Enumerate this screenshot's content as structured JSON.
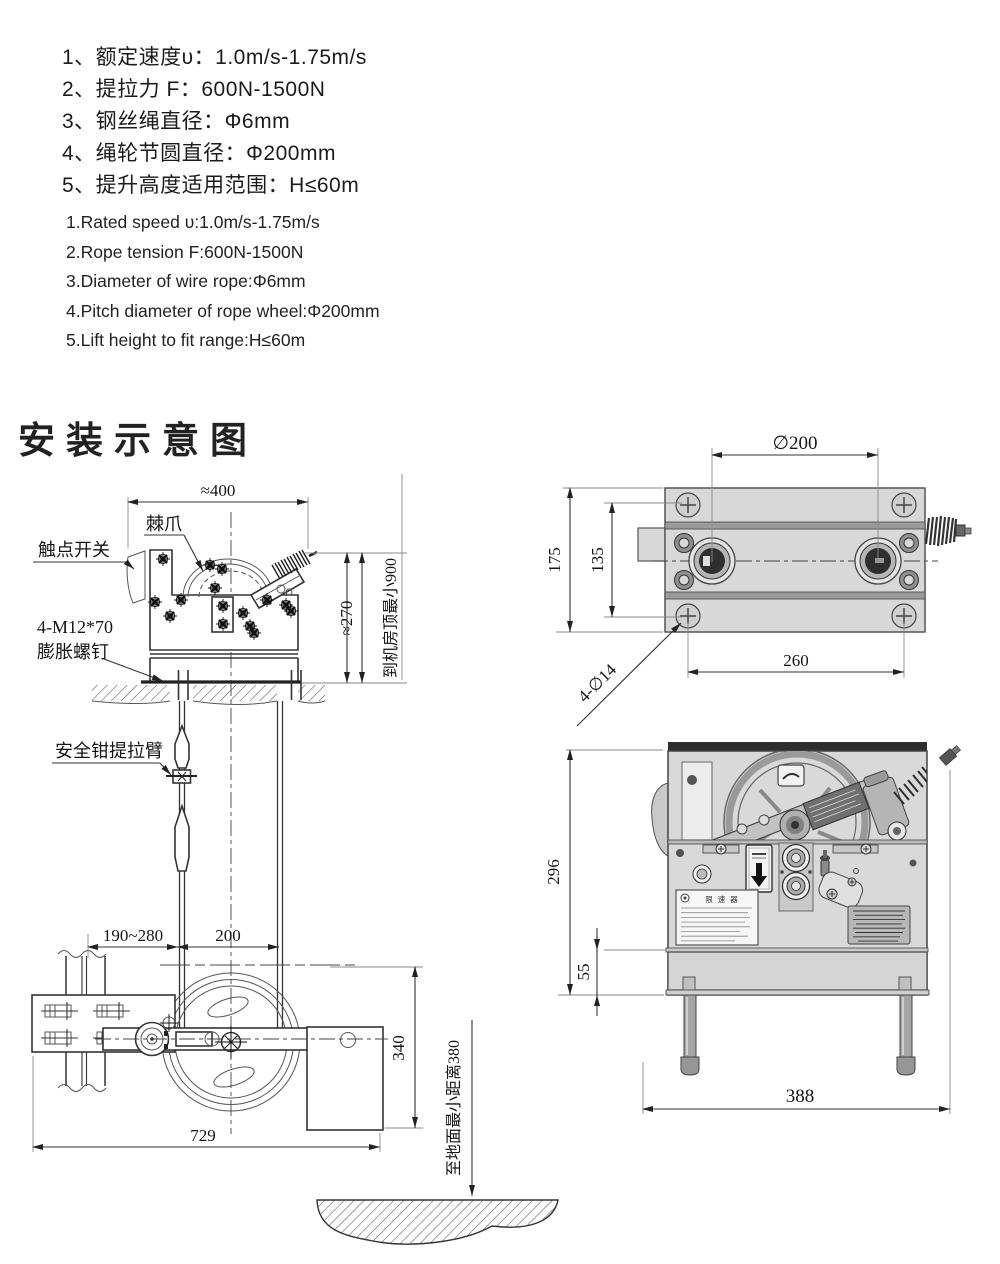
{
  "specs_cn": {
    "items": [
      "1、额定速度υ：1.0m/s-1.75m/s",
      "2、提拉力 F：600N-1500N",
      "3、钢丝绳直径：Φ6mm",
      "4、绳轮节圆直径：Φ200mm",
      "5、提升高度适用范围：H≤60m"
    ]
  },
  "specs_en": {
    "items": [
      "1.Rated speed υ:1.0m/s-1.75m/s",
      "2.Rope tension F:600N-1500N",
      "3.Diameter of wire rope:Φ6mm",
      "4.Pitch diameter of rope wheel:Φ200mm",
      "5.Lift height to fit range:H≤60m"
    ]
  },
  "section_title": "安装示意图",
  "front_view": {
    "labels": {
      "pawl": "棘爪",
      "contact_switch": "触点开关",
      "anchor_bolt_spec": "4-M12*70",
      "anchor_bolt_name": "膨胀螺钉",
      "safety_gear_arm": "安全钳提拉臂"
    },
    "dims": {
      "top_width": "≈400",
      "body_height": "≈270",
      "ceiling_clearance": "到机房顶最小900",
      "rail_to_rope": "190~280",
      "rope_gauge": "200",
      "tensioner_height": "340",
      "overall_width": "729",
      "floor_clearance": "至地面最小距离380"
    }
  },
  "top_view": {
    "dims": {
      "wheel_pitch": "∅200",
      "body_depth": "175",
      "bolt_row_span": "135",
      "bolt_col_span": "260",
      "mount_holes": "4-∅14"
    }
  },
  "side_view": {
    "dims": {
      "overall_height": "296",
      "base_height": "55",
      "overall_width": "388"
    },
    "nameplate_title": "限速器"
  },
  "colors": {
    "paper": "#ffffff",
    "line": "#333333",
    "metal_light": "#d9d9d9",
    "metal_mid": "#b5b5b5",
    "metal_dark": "#2e2e2e"
  }
}
